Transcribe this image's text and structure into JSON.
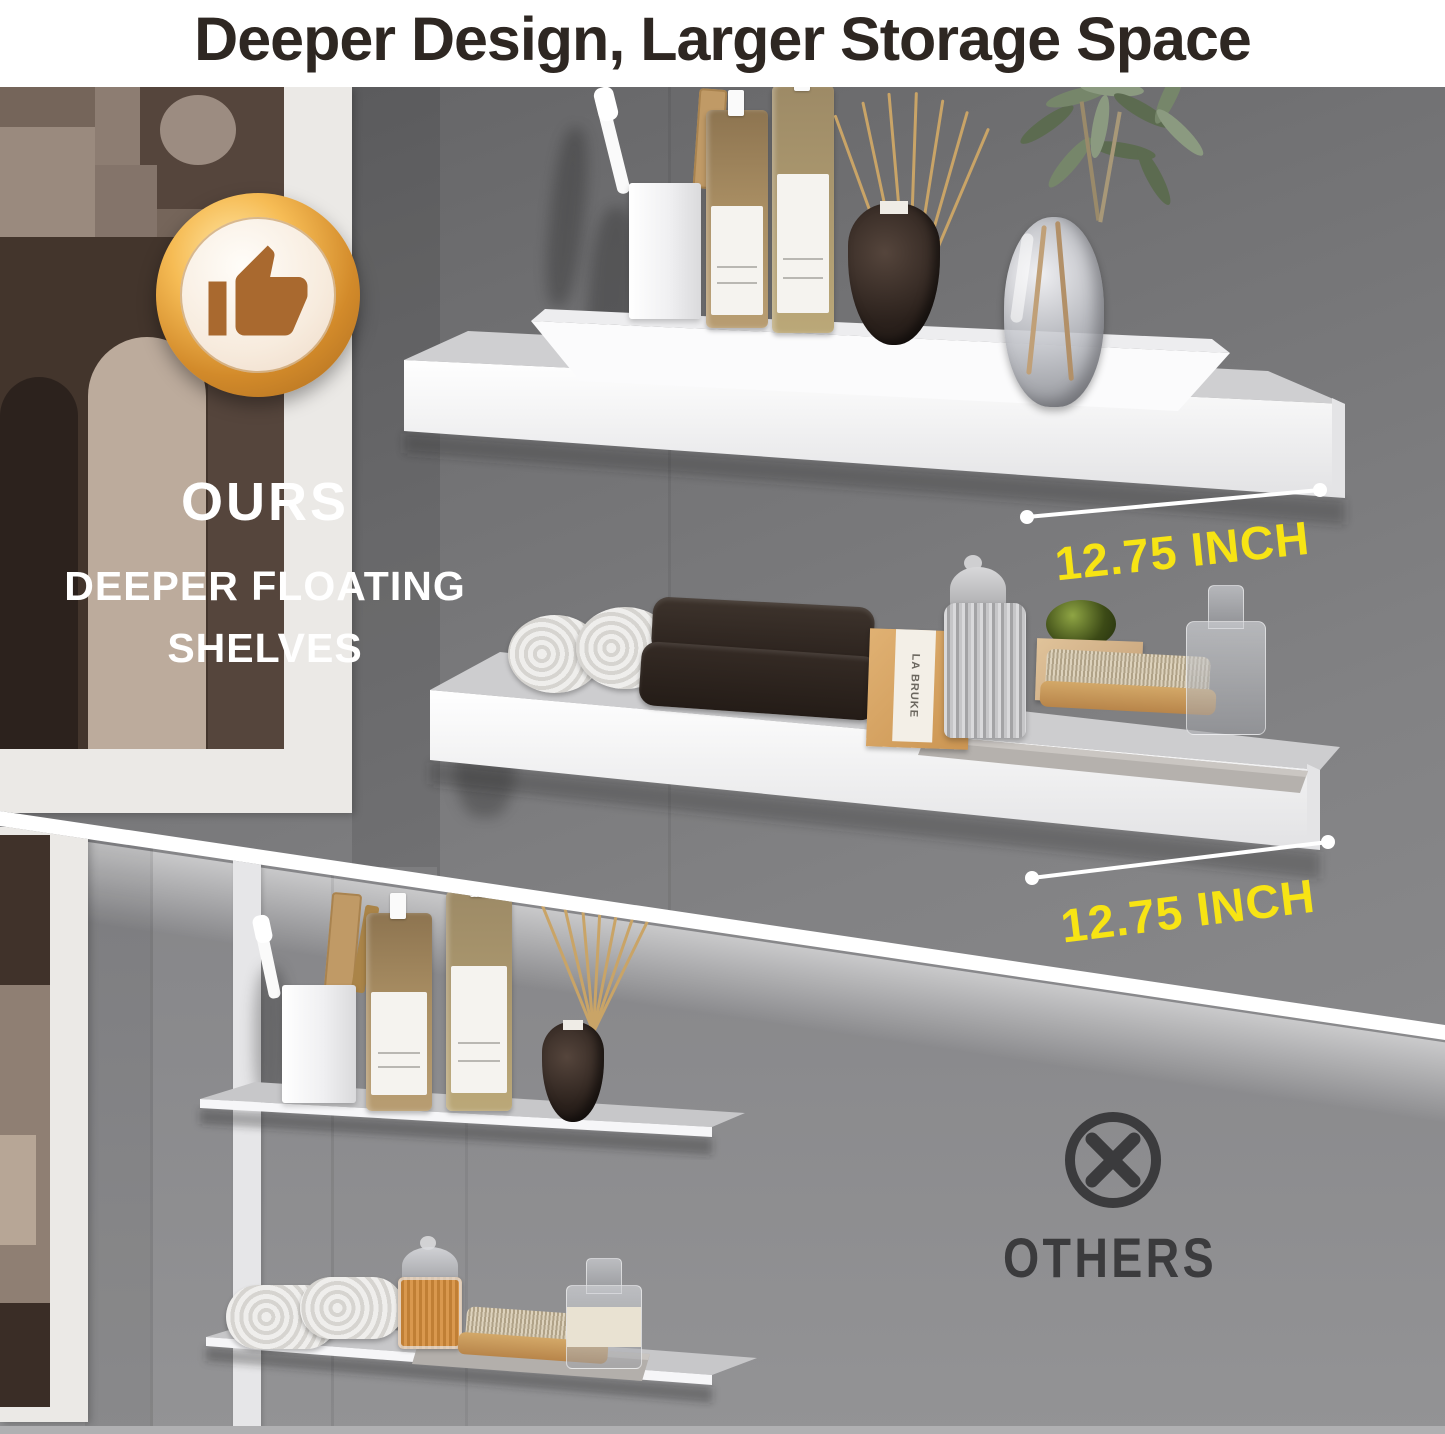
{
  "header": {
    "title": "Deeper Design, Larger Storage Space"
  },
  "ours": {
    "badge_icon": "thumbs-up-icon",
    "heading": "OURS",
    "subheading": "DEEPER FLOATING SHELVES",
    "shelf1_depth_label": "12.75 INCH",
    "shelf2_depth_label": "12.75 INCH",
    "soap_box_label": "LA BRUKE"
  },
  "others": {
    "icon": "x-circle-icon",
    "heading": "OTHERS"
  },
  "colors": {
    "title_text": "#2e2722",
    "accent_yellow": "#f7e414",
    "others_dark": "#3b3b3d",
    "badge_gold": "#d28a2a",
    "thumb_brown": "#a9692f",
    "shelf_white": "#f4f4f6",
    "wall_grey_ours": "#7c7c7e",
    "wall_grey_others": "#8d8d90"
  }
}
